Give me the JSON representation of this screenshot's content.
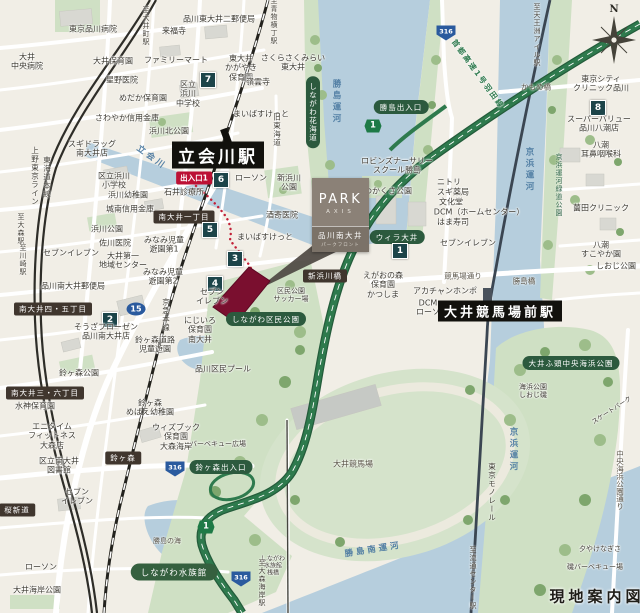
{
  "title": "現地案内図",
  "brand": {
    "park": "PARK",
    "axis": "AXIS",
    "property_name": "品川南大井",
    "property_sub": "パークフロント"
  },
  "colors": {
    "land": "#f1eee6",
    "water": "#b6cedd",
    "park": "#cfe0c4",
    "highway": "#2e7a4d",
    "property_site": "#7a0f2f",
    "walking_route": "#c22037",
    "spot_badge": "#1c4449",
    "area_pill": "#40362e",
    "green_pill": "#2c5a3e",
    "exit_pill": "#bc1135",
    "route_shield_blue": "#2a5a9e",
    "station_bg": "#12110d",
    "brand_box": "#8b8177"
  },
  "map": {
    "compass_n": "N",
    "labels": [
      {
        "n": "dir-oimachi",
        "t": "至大井町駅",
        "x": 146,
        "y": 26,
        "c": "dir",
        "v": 1
      },
      {
        "n": "poi-hospital",
        "t": "東京品川病院",
        "x": 93,
        "y": 29,
        "c": "poi"
      },
      {
        "n": "poi-post-office",
        "t": "品川東大井二郵便局",
        "x": 219,
        "y": 19,
        "c": "poi"
      },
      {
        "n": "poi-temple",
        "t": "来福寺",
        "x": 174,
        "y": 31,
        "c": "poi"
      },
      {
        "n": "poi-hospital",
        "t": "大井\n中央病院",
        "x": 27,
        "y": 62,
        "c": "poi"
      },
      {
        "n": "poi-nursery",
        "t": "大井保育園",
        "x": 113,
        "y": 61,
        "c": "poi"
      },
      {
        "n": "poi-store",
        "t": "ファミリーマート",
        "x": 176,
        "y": 60,
        "c": "poi"
      },
      {
        "n": "poi-nursery",
        "t": "東大井\nかがやき\n保育園",
        "x": 241,
        "y": 68,
        "c": "poi"
      },
      {
        "n": "poi-nursery",
        "t": "さくらさくみらい\n東大井",
        "x": 293,
        "y": 63,
        "c": "poi"
      },
      {
        "n": "poi-temple",
        "t": "嶺雲寺",
        "x": 258,
        "y": 82,
        "c": "poi"
      },
      {
        "n": "poi-clinic",
        "t": "星野医院",
        "x": 122,
        "y": 80,
        "c": "poi"
      },
      {
        "n": "poi-school",
        "t": "区立\n浜川\n中学校",
        "x": 188,
        "y": 94,
        "c": "poi"
      },
      {
        "n": "spot-badge-7",
        "t": "7",
        "x": 208,
        "y": 80,
        "c": "num"
      },
      {
        "n": "poi-nursery",
        "t": "めだか保育園",
        "x": 143,
        "y": 98,
        "c": "poi"
      },
      {
        "n": "poi-store",
        "t": "まいばすけっと",
        "x": 261,
        "y": 114,
        "c": "poi"
      },
      {
        "n": "poi-bank",
        "t": "さわやか信用金庫",
        "x": 127,
        "y": 118,
        "c": "poi"
      },
      {
        "n": "poi-park",
        "t": "浜川北公園",
        "x": 169,
        "y": 131,
        "c": "poi"
      },
      {
        "n": "poi-store",
        "t": "スギドラッグ\n南大井店",
        "x": 92,
        "y": 149,
        "c": "poi"
      },
      {
        "n": "dir-aomono-yokocho",
        "t": "至青物横丁駅",
        "x": 274,
        "y": 21,
        "c": "dir",
        "v": 1
      },
      {
        "n": "road-kyu-tokaido",
        "t": "旧東海道",
        "x": 277,
        "y": 130,
        "c": "rail",
        "v": 1
      },
      {
        "n": "pill-hanakaido",
        "t": "しながわ花海道",
        "x": 313,
        "y": 112,
        "c": "pillg",
        "v": 1
      },
      {
        "n": "water-katsushima-canal",
        "t": "勝島運河",
        "x": 336,
        "y": 102,
        "c": "water",
        "v": 1
      },
      {
        "n": "pill-katsushima-exit",
        "t": "勝島出入口",
        "x": 401,
        "y": 107,
        "c": "pillg"
      },
      {
        "n": "shield-shuto-1",
        "t": "1",
        "x": 373,
        "y": 126,
        "c": "s1"
      },
      {
        "n": "shield-316",
        "t": "316",
        "x": 446,
        "y": 33,
        "c": "s316"
      },
      {
        "n": "road-shuto-expressway",
        "t": "首都高速1号羽田線",
        "x": 478,
        "y": 74,
        "c": "hwy",
        "r": 54
      },
      {
        "n": "road-kamome-bridge",
        "t": "かもめ橋",
        "x": 536,
        "y": 87,
        "c": "road"
      },
      {
        "n": "dir-tennozu-isle",
        "t": "至天王洲アイル駅",
        "x": 537,
        "y": 35,
        "c": "dir",
        "v": 1
      },
      {
        "n": "poi-clinic",
        "t": "東京シティ\nクリニック品川",
        "x": 601,
        "y": 84,
        "c": "poi"
      },
      {
        "n": "spot-badge-8",
        "t": "8",
        "x": 598,
        "y": 108,
        "c": "num"
      },
      {
        "n": "poi-store",
        "t": "スーパーバリュー\n品川八潮店",
        "x": 599,
        "y": 124,
        "c": "poi"
      },
      {
        "n": "water-keihin-canal-n",
        "t": "京浜運河",
        "x": 529,
        "y": 170,
        "c": "water",
        "v": 1
      },
      {
        "n": "park-keihin-greenway",
        "t": "京浜運河緑道公園",
        "x": 559,
        "y": 185,
        "c": "parkl",
        "v": 1
      },
      {
        "n": "poi-clinic",
        "t": "八潮\n耳鼻咽喉科",
        "x": 601,
        "y": 150,
        "c": "poi"
      },
      {
        "n": "poi-clinic",
        "t": "薗田クリニック",
        "x": 601,
        "y": 208,
        "c": "poi"
      },
      {
        "n": "poi-nursery",
        "t": "八潮\nすこやか園",
        "x": 601,
        "y": 250,
        "c": "poi"
      },
      {
        "n": "poi-park",
        "t": "しおじ公園",
        "x": 616,
        "y": 266,
        "c": "poi"
      },
      {
        "n": "rail-ueno-tokyo-line",
        "t": "上野東京ライン",
        "x": 35,
        "y": 176,
        "c": "rail",
        "v": 1
      },
      {
        "n": "rail-tokaido-line",
        "t": "東海道本線",
        "x": 47,
        "y": 177,
        "c": "rail",
        "v": 1
      },
      {
        "n": "dir-omori",
        "t": "至大森駅",
        "x": 21,
        "y": 229,
        "c": "dir",
        "v": 1
      },
      {
        "n": "dir-kawasaki",
        "t": "至川崎駅",
        "x": 23,
        "y": 260,
        "c": "dir",
        "v": 1
      },
      {
        "n": "station-tachiaikawa",
        "t": "立会川駅",
        "x": 218,
        "y": 155,
        "c": "sta",
        "fs": 17
      },
      {
        "n": "exit-1-badge",
        "t": "出入口1",
        "x": 194,
        "y": 178,
        "c": "pillr"
      },
      {
        "n": "spot-badge-6",
        "t": "6",
        "x": 221,
        "y": 180,
        "c": "num"
      },
      {
        "n": "poi-store",
        "t": "ローソン",
        "x": 251,
        "y": 178,
        "c": "poi"
      },
      {
        "n": "poi-park",
        "t": "新浜川\n公園",
        "x": 289,
        "y": 183,
        "c": "poi"
      },
      {
        "n": "water-tachiaigawa",
        "t": "立会川",
        "x": 152,
        "y": 157,
        "c": "water",
        "r": 36
      },
      {
        "n": "poi-school",
        "t": "区立浜川\n小学校",
        "x": 114,
        "y": 181,
        "c": "poi"
      },
      {
        "n": "poi-kindergarten",
        "t": "浜川幼稚園",
        "x": 128,
        "y": 195,
        "c": "poi"
      },
      {
        "n": "poi-clinic",
        "t": "石井診療所",
        "x": 184,
        "y": 192,
        "c": "poi"
      },
      {
        "n": "poi-bank",
        "t": "城南信用金庫",
        "x": 130,
        "y": 209,
        "c": "poi"
      },
      {
        "n": "pill-minamioi-1chome",
        "t": "南大井一丁目",
        "x": 184,
        "y": 217,
        "c": "pill"
      },
      {
        "n": "spot-badge-5",
        "t": "5",
        "x": 210,
        "y": 230,
        "c": "num"
      },
      {
        "n": "poi-park",
        "t": "浜川公園",
        "x": 107,
        "y": 229,
        "c": "poi"
      },
      {
        "n": "poi-clinic",
        "t": "酒寄医院",
        "x": 282,
        "y": 215,
        "c": "poi"
      },
      {
        "n": "poi-store",
        "t": "まいばすけっと",
        "x": 265,
        "y": 237,
        "c": "poi"
      },
      {
        "n": "poi-clinic",
        "t": "佐川医院",
        "x": 115,
        "y": 243,
        "c": "poi"
      },
      {
        "n": "poi-park",
        "t": "みなみ児童\n遊園第1",
        "x": 164,
        "y": 245,
        "c": "poi"
      },
      {
        "n": "poi-store",
        "t": "セブンイレブン",
        "x": 71,
        "y": 253,
        "c": "poi"
      },
      {
        "n": "poi-center",
        "t": "大井第一\n地域センター",
        "x": 123,
        "y": 261,
        "c": "poi"
      },
      {
        "n": "spot-badge-3",
        "t": "3",
        "x": 235,
        "y": 259,
        "c": "num"
      },
      {
        "n": "poi-park",
        "t": "みなみ児童\n遊園第2",
        "x": 163,
        "y": 277,
        "c": "poi"
      },
      {
        "n": "spot-badge-4",
        "t": "4",
        "x": 215,
        "y": 284,
        "c": "num"
      },
      {
        "n": "poi-store",
        "t": "セブン\nイレブン",
        "x": 212,
        "y": 297,
        "c": "poi"
      },
      {
        "n": "poi-post-office",
        "t": "品川南大井郵便局",
        "x": 73,
        "y": 286,
        "c": "poi"
      },
      {
        "n": "pill-minamioi-45chome",
        "t": "南大井四・五丁目",
        "x": 53,
        "y": 309,
        "c": "pill"
      },
      {
        "n": "spot-badge-2",
        "t": "2",
        "x": 110,
        "y": 320,
        "c": "num"
      },
      {
        "n": "shield-route-15",
        "t": "15",
        "x": 136,
        "y": 309,
        "c": "s15"
      },
      {
        "n": "rail-keikyu-line",
        "t": "京急本線",
        "x": 166,
        "y": 315,
        "c": "rail",
        "v": 1
      },
      {
        "n": "poi-store",
        "t": "そうざフローゼン\n品川南大井店",
        "x": 106,
        "y": 332,
        "c": "poi"
      },
      {
        "n": "poi-park",
        "t": "鈴ヶ森道路\n児童遊園",
        "x": 155,
        "y": 345,
        "c": "poi"
      },
      {
        "n": "poi-nursery",
        "t": "にじいろ\n保育園\n南大井",
        "x": 200,
        "y": 330,
        "c": "poi"
      },
      {
        "n": "poi-park",
        "t": "鈴ヶ森公園",
        "x": 79,
        "y": 373,
        "c": "poi"
      },
      {
        "n": "pill-minamioi-36chome",
        "t": "南大井三・六丁目",
        "x": 45,
        "y": 393,
        "c": "pill"
      },
      {
        "n": "poi-nursery",
        "t": "水神保育園",
        "x": 35,
        "y": 406,
        "c": "poi"
      },
      {
        "n": "poi-kindergarten",
        "t": "鈴ヶ森\nめばえ幼稚園",
        "x": 150,
        "y": 408,
        "c": "poi"
      },
      {
        "n": "poi-nursery",
        "t": "ウィズブック\n保育園\n大森海岸",
        "x": 176,
        "y": 437,
        "c": "poi"
      },
      {
        "n": "poi-gym",
        "t": "エニタイム\nフィットネス\n大森店",
        "x": 52,
        "y": 436,
        "c": "poi"
      },
      {
        "n": "pill-kumin-park",
        "t": "しながわ区民公園",
        "x": 266,
        "y": 319,
        "c": "pillg"
      },
      {
        "n": "poi-soccer-field",
        "t": "区民公園\nサッカー場",
        "x": 291,
        "y": 295,
        "c": "poi",
        "fs": 7
      },
      {
        "n": "pill-shinhamakawa-bridge",
        "t": "新浜川橋",
        "x": 325,
        "y": 276,
        "c": "pill"
      },
      {
        "n": "poi-pool",
        "t": "品川区民プール",
        "x": 223,
        "y": 369,
        "c": "poi"
      },
      {
        "n": "poi-park",
        "t": "わかくさ公園",
        "x": 388,
        "y": 191,
        "c": "poi"
      },
      {
        "n": "poi-school",
        "t": "ロビンズナーサリー\nスクール勝島",
        "x": 397,
        "y": 166,
        "c": "poi"
      },
      {
        "n": "poi-store",
        "t": "ニトリ",
        "x": 449,
        "y": 182,
        "c": "poi"
      },
      {
        "n": "poi-store",
        "t": "スギ薬局",
        "x": 453,
        "y": 192,
        "c": "poi"
      },
      {
        "n": "poi-store",
        "t": "文化堂",
        "x": 451,
        "y": 202,
        "c": "poi"
      },
      {
        "n": "poi-store",
        "t": "DCM（ホームセンター）",
        "x": 479,
        "y": 212,
        "c": "poi"
      },
      {
        "n": "poi-restaurant",
        "t": "はま寿司",
        "x": 453,
        "y": 222,
        "c": "poi"
      },
      {
        "n": "poi-store",
        "t": "セブンイレブン",
        "x": 468,
        "y": 243,
        "c": "poi"
      },
      {
        "n": "pill-willa-oi",
        "t": "ウィラ大井",
        "x": 397,
        "y": 237,
        "c": "pillg"
      },
      {
        "n": "spot-badge-1",
        "t": "1",
        "x": 400,
        "y": 251,
        "c": "num"
      },
      {
        "n": "poi-nursery",
        "t": "えがおの森\n保育園\nかつしま",
        "x": 383,
        "y": 285,
        "c": "poi"
      },
      {
        "n": "road-keibajo-dori",
        "t": "競馬場通り",
        "x": 463,
        "y": 276,
        "c": "road"
      },
      {
        "n": "road-katsushima-bridge",
        "t": "勝島橋",
        "x": 524,
        "y": 281,
        "c": "road"
      },
      {
        "n": "poi-store",
        "t": "アカチャンホンポ",
        "x": 445,
        "y": 291,
        "c": "poi"
      },
      {
        "n": "poi-store",
        "t": "DCM",
        "x": 428,
        "y": 303,
        "c": "poi"
      },
      {
        "n": "poi-store",
        "t": "ローソン",
        "x": 432,
        "y": 312,
        "c": "poi"
      },
      {
        "n": "station-oi-keibajo-mae",
        "t": "大井競馬場前駅",
        "x": 500,
        "y": 311,
        "c": "sta",
        "fs": 13
      },
      {
        "n": "pill-oi-futo-kaihin-park",
        "t": "大井ふ頭中央海浜公園",
        "x": 571,
        "y": 363,
        "c": "pillg"
      },
      {
        "n": "poi-beach",
        "t": "海浜公園\nしおじ磯",
        "x": 533,
        "y": 391,
        "c": "poi",
        "fs": 7
      },
      {
        "n": "poi-skatepark",
        "t": "スケートパーク",
        "x": 612,
        "y": 411,
        "c": "poi",
        "r": -33,
        "fs": 6.5
      },
      {
        "n": "water-keihin-canal-s",
        "t": "京浜運河",
        "x": 513,
        "y": 450,
        "c": "water",
        "v": 1
      },
      {
        "n": "rail-tokyo-monorail",
        "t": "東京モノレール",
        "x": 492,
        "y": 492,
        "c": "rail",
        "v": 1
      },
      {
        "n": "dir-ryutsu-center",
        "t": "至流通センター駅",
        "x": 473,
        "y": 578,
        "c": "dir",
        "v": 1
      },
      {
        "n": "road-chuo-kaihin-dori",
        "t": "中央海浜公園通り",
        "x": 620,
        "y": 480,
        "c": "road",
        "v": 1
      },
      {
        "n": "poi-beach",
        "t": "夕やけなぎさ",
        "x": 600,
        "y": 549,
        "c": "poi",
        "fs": 7
      },
      {
        "n": "poi-bbq",
        "t": "磯バーベキュー場",
        "x": 595,
        "y": 567,
        "c": "poi",
        "fs": 7
      },
      {
        "n": "poi-oi-racecourse",
        "t": "大井競馬場",
        "x": 353,
        "y": 464,
        "c": "road",
        "fs": 8
      },
      {
        "n": "water-katsushima-minami-canal",
        "t": "勝島南運河",
        "x": 373,
        "y": 549,
        "c": "water",
        "r": -9
      },
      {
        "n": "water-katsushima-no-umi",
        "t": "勝島の海",
        "x": 167,
        "y": 541,
        "c": "road",
        "fs": 7
      },
      {
        "n": "pill-shinagawa-aquarium",
        "t": "しながわ水族館",
        "x": 174,
        "y": 572,
        "c": "oval"
      },
      {
        "n": "poi-pier",
        "t": "しながわ\n水族館\n桟橋",
        "x": 273,
        "y": 566,
        "c": "poi",
        "fs": 6
      },
      {
        "n": "shield-shuto-1b",
        "t": "1",
        "x": 206,
        "y": 527,
        "c": "s1"
      },
      {
        "n": "shield-316b",
        "t": "316",
        "x": 175,
        "y": 469,
        "c": "s316"
      },
      {
        "n": "shield-316c",
        "t": "316",
        "x": 241,
        "y": 579,
        "c": "s316"
      },
      {
        "n": "pill-suzugamori-exit",
        "t": "鈴ヶ森出入口",
        "x": 221,
        "y": 467,
        "c": "pillg"
      },
      {
        "n": "pill-suzugamori",
        "t": "鈴ヶ森",
        "x": 123,
        "y": 458,
        "c": "pill"
      },
      {
        "n": "poi-bbq",
        "t": "バーベキュー広場",
        "x": 218,
        "y": 444,
        "c": "poi",
        "fs": 7
      },
      {
        "n": "poi-library",
        "t": "区立南大井\n図書館",
        "x": 59,
        "y": 466,
        "c": "poi"
      },
      {
        "n": "poi-store",
        "t": "セブン\nイレブン",
        "x": 77,
        "y": 497,
        "c": "poi"
      },
      {
        "n": "pill-sakura-shindo",
        "t": "桜新道",
        "x": 17,
        "y": 510,
        "c": "pill"
      },
      {
        "n": "poi-store",
        "t": "ローソン",
        "x": 41,
        "y": 567,
        "c": "poi"
      },
      {
        "n": "poi-park",
        "t": "大井海岸公園",
        "x": 37,
        "y": 590,
        "c": "poi"
      },
      {
        "n": "dir-omori-kaigan",
        "t": "至大森海岸駅",
        "x": 262,
        "y": 583,
        "c": "dir",
        "v": 1
      }
    ]
  }
}
